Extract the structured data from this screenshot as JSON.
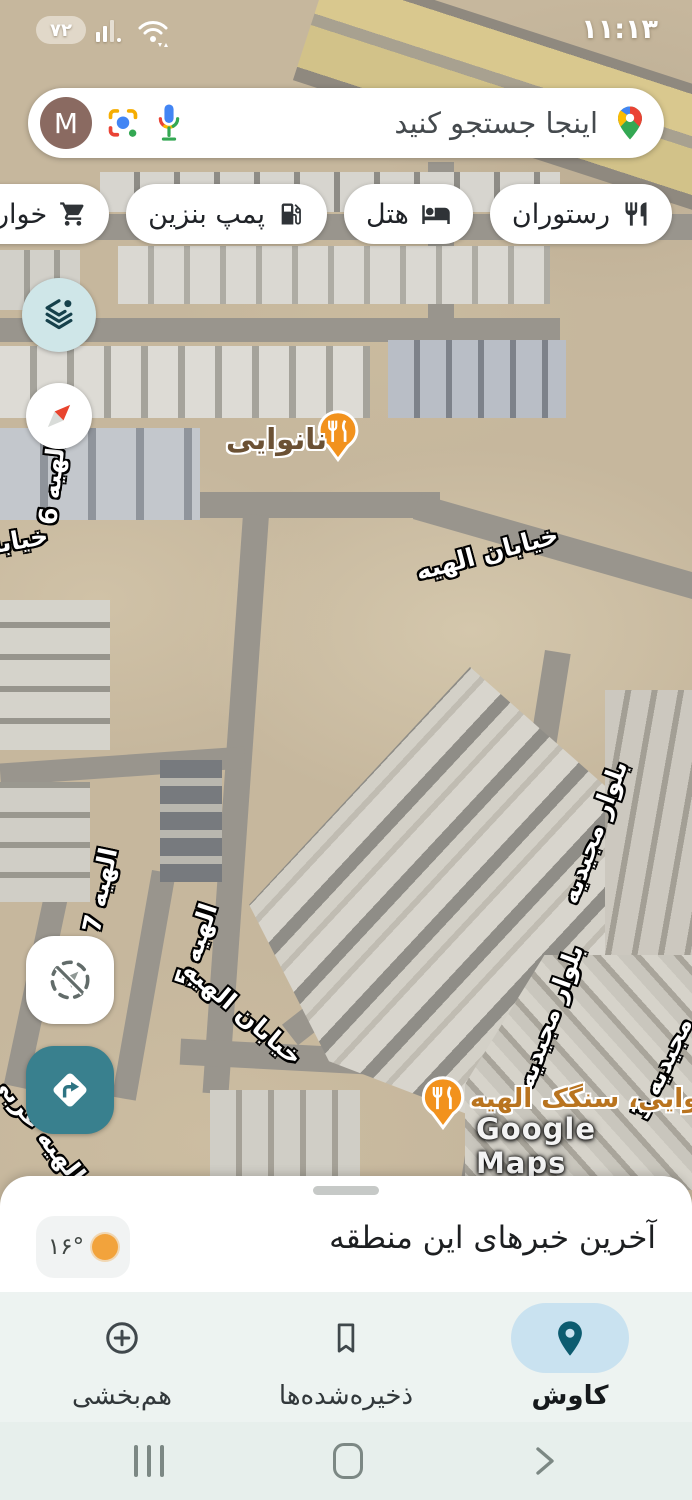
{
  "status_bar": {
    "battery_percent": "۷۲",
    "time": "۱۱:۱۳"
  },
  "search_bar": {
    "query_placeholder": "اینجا جستجو کنید",
    "avatar_initial": "M"
  },
  "category_chips": {
    "restaurant": "رستوران",
    "hotel": "هتل",
    "gas_station": "پمپ بنزین",
    "grocery": "خواربارفروشی"
  },
  "map_labels": {
    "bakery_poi": "نانوایی",
    "elahiyeh_street_upper": "خیابان الهیه",
    "elahiyeh_6": "الهیه 6",
    "khiaban_edge": "خیابا",
    "elahiyeh_7": "الهیه 7",
    "elahiyeh_5": "الهیه 5",
    "elahiyeh_street_lower": "خیابان الهیه",
    "majidiyeh_blvd_upper": "بلوار مجیدیه",
    "majidiyeh_blvd_lower": "بلوار مجیدیه",
    "majidiyeh_3": "مجیدیه 3",
    "elahiyeh_gharbi_2": "الهیه غربی 2",
    "sangak_bakery_poi": "نانوایی، سنگک الهیه",
    "watermark": "Google Maps"
  },
  "bottom_sheet": {
    "title": "آخرین خبرهای این منطقه",
    "temperature": "۱۶°"
  },
  "bottom_nav": {
    "explore": "کاوش",
    "saved": "ذخیره‌شده‌ها",
    "contribute": "هم‌بخشی"
  },
  "colors": {
    "accent_teal": "#39808e",
    "poi_orange": "#f2921d",
    "nav_active_pill": "#c9e2f0",
    "desert_tan": "#c6b79d"
  }
}
